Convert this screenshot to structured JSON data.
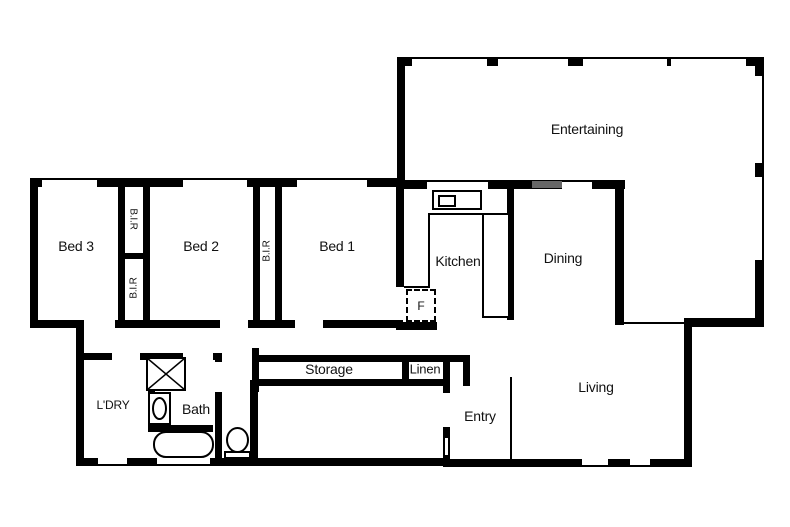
{
  "labels": {
    "entertaining": "Entertaining",
    "bed1": "Bed 1",
    "bed2": "Bed 2",
    "bed3": "Bed 3",
    "bir": "B.I.R",
    "kitchen": "Kitchen",
    "dining": "Dining",
    "living": "Living",
    "entry": "Entry",
    "storage": "Storage",
    "linen": "Linen",
    "laundry": "L'DRY",
    "bath": "Bath",
    "fridge": "F"
  },
  "colors": {
    "wall": "#000000",
    "background": "#ffffff",
    "beam": "#666666",
    "text": "#111111"
  }
}
